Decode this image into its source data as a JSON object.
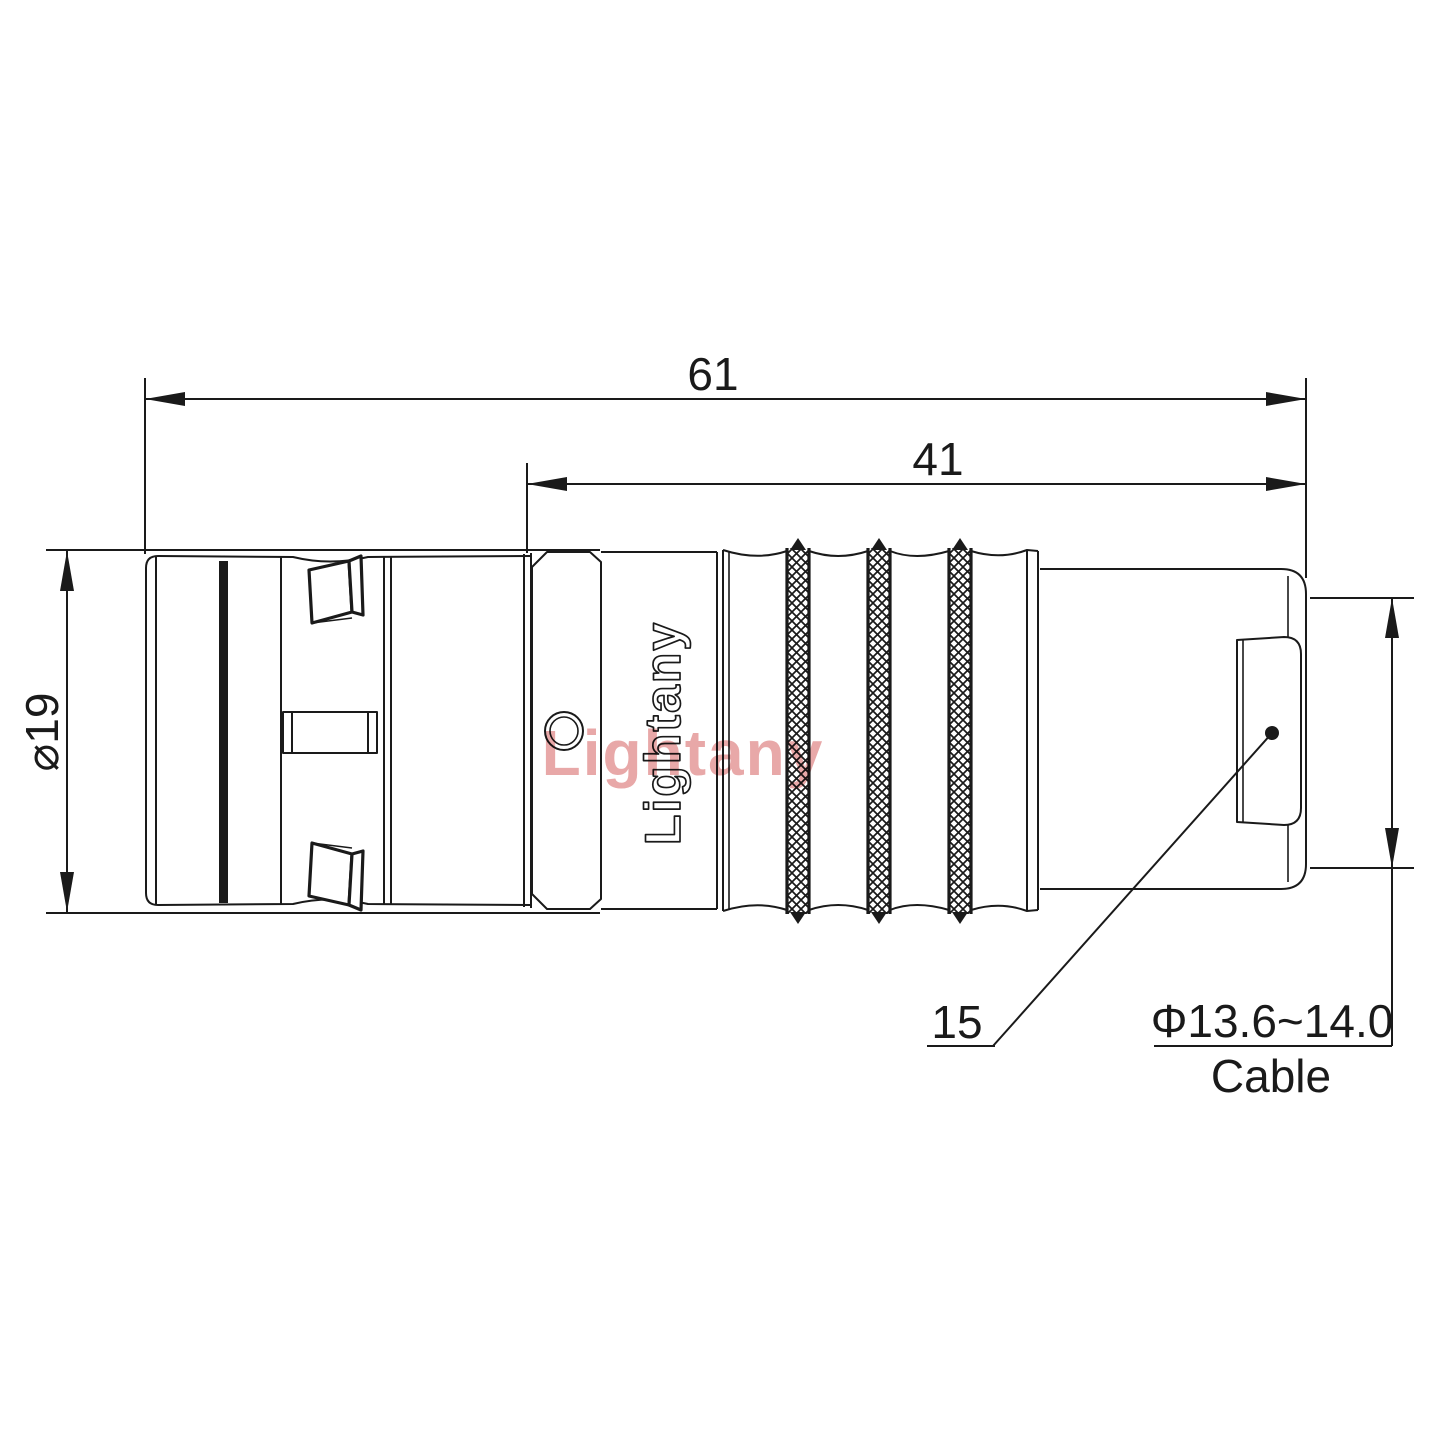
{
  "page": {
    "background": "#ffffff",
    "line_color": "#1a1a1a",
    "watermark_color": "#e8a8a8"
  },
  "dimensions": {
    "overall_length": "61",
    "rear_length": "41",
    "body_diameter": "⌀19",
    "part_ref": "15",
    "cable_diameter": "Φ13.6~14.0",
    "cable_word": "Cable"
  },
  "branding": {
    "engraving": "Lightany",
    "watermark": "Lightany"
  }
}
